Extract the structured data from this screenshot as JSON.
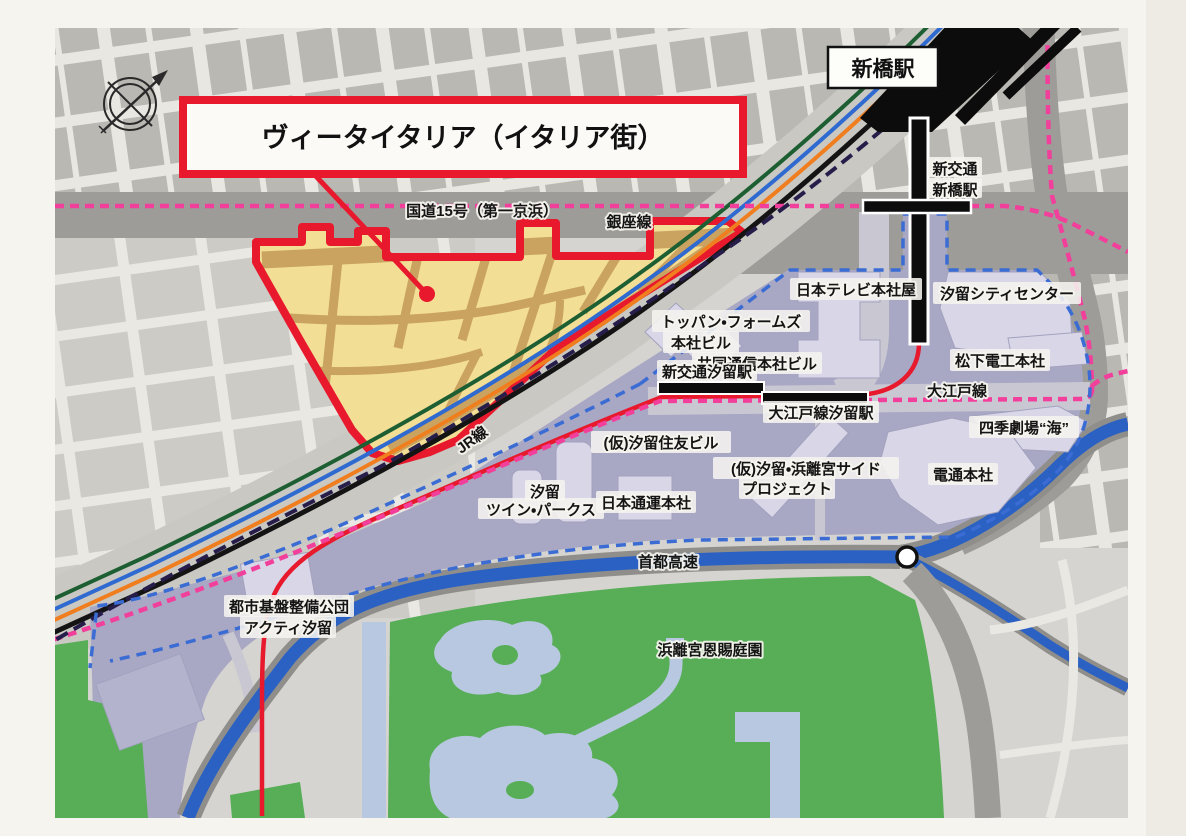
{
  "map_title": "ヴィータイタリア（イタリア街）",
  "roads": {
    "route15": "国道15号（第一京浜）",
    "shuto_expressway": "首都高速"
  },
  "transit": {
    "ginza_line": "銀座線",
    "jr_line": "JR線",
    "oedo_line": "大江戸線",
    "stations": {
      "shimbashi": "新橋駅",
      "new_transit_shimbashi_l1": "新交通",
      "new_transit_shimbashi_l2": "新橋駅",
      "new_transit_shiodome": "新交通汐留駅",
      "oedo_shiodome": "大江戸線汐留駅"
    }
  },
  "places": {
    "ntv": "日本テレビ本社屋",
    "shiodome_city_center": "汐留シティセンター",
    "toppan_forms_l1": "トッパン・フォームズ",
    "toppan_forms_l2": "本社ビル",
    "kyodo_news": "共同通信本社ビル",
    "matsushita": "松下電工本社",
    "shiki_theatre": "四季劇場“海”",
    "sumitomo": "(仮)汐留住友ビル",
    "hamarikyu_side_l1": "(仮)汐留・浜離宮サイド",
    "hamarikyu_side_l2": "プロジェクト",
    "dentsu": "電通本社",
    "twin_parks_l1": "汐留",
    "twin_parks_l2": "ツイン・パークス",
    "nittsu": "日本通運本社",
    "acty_l1": "都市基盤整備公団",
    "acty_l2": "アクティ汐留",
    "hamarikyu_garden": "浜離宮恩賜庭園"
  },
  "icons": {
    "compass": "compass-rose",
    "junction": "expressway-junction-circle"
  },
  "colors": {
    "paper": "#f5f4ee",
    "map_bg": "#d5d4d0",
    "block_grey": "#b9b8b3",
    "street_light": "#e8e7e2",
    "road_grey": "#9d9c98",
    "corridor_grey": "#c9c8c3",
    "district_yellow": "#f3de96",
    "district_tan": "#c9a35f",
    "accent_red": "#e8192d",
    "purple_area": "#a8a7c4",
    "building_light": "#d8d6e7",
    "park_green": "#57ae57",
    "pond_blue": "#b7c8e0",
    "canal_blue": "#2a61c3",
    "line_green": "#1d5f32",
    "line_blue": "#2f6ad0",
    "line_orange": "#f07d1e",
    "line_black": "#141414",
    "line_pink": "#f23f9b",
    "line_navy": "#271d4a",
    "boundary_blue": "#3a6cd4"
  }
}
